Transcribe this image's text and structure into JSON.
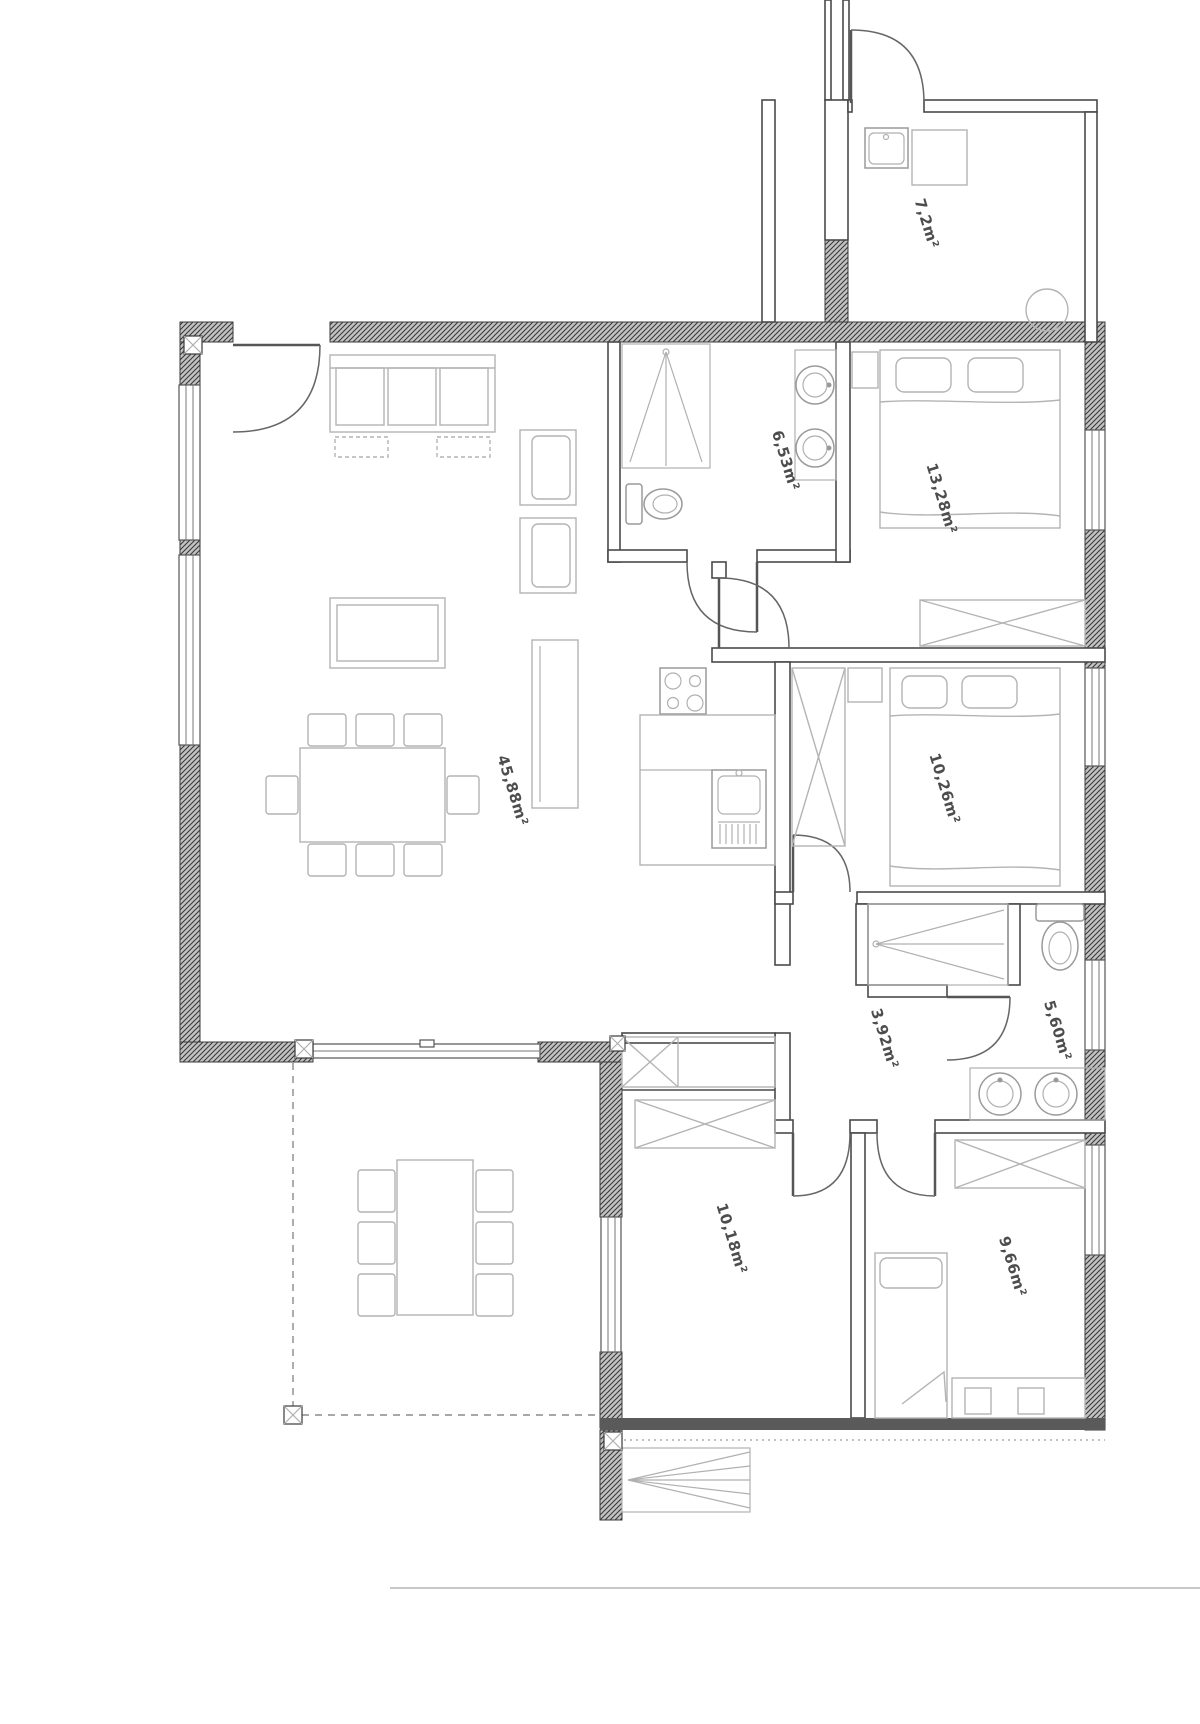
{
  "document": {
    "type_label": "apartment-floor-plan"
  },
  "rooms": [
    {
      "name": "storage-room",
      "area_label": "7,2m²"
    },
    {
      "name": "bathroom-1",
      "area_label": "6,53m²"
    },
    {
      "name": "bedroom-1",
      "area_label": "13,28m²"
    },
    {
      "name": "living-room-kitchen",
      "area_label": "45,88m²"
    },
    {
      "name": "bedroom-2",
      "area_label": "10,26m²"
    },
    {
      "name": "hallway",
      "area_label": "3,92m²"
    },
    {
      "name": "bathroom-2",
      "area_label": "5,60m²"
    },
    {
      "name": "bedroom-3",
      "area_label": "10,18m²"
    },
    {
      "name": "bedroom-4",
      "area_label": "9,66m²"
    }
  ],
  "style": {
    "wall_color": "#3a3a3a",
    "furniture_color": "#b4b4b4",
    "fixture_color": "#9a9a9a",
    "label_color": "#4d4d4d",
    "background": "#ffffff"
  }
}
